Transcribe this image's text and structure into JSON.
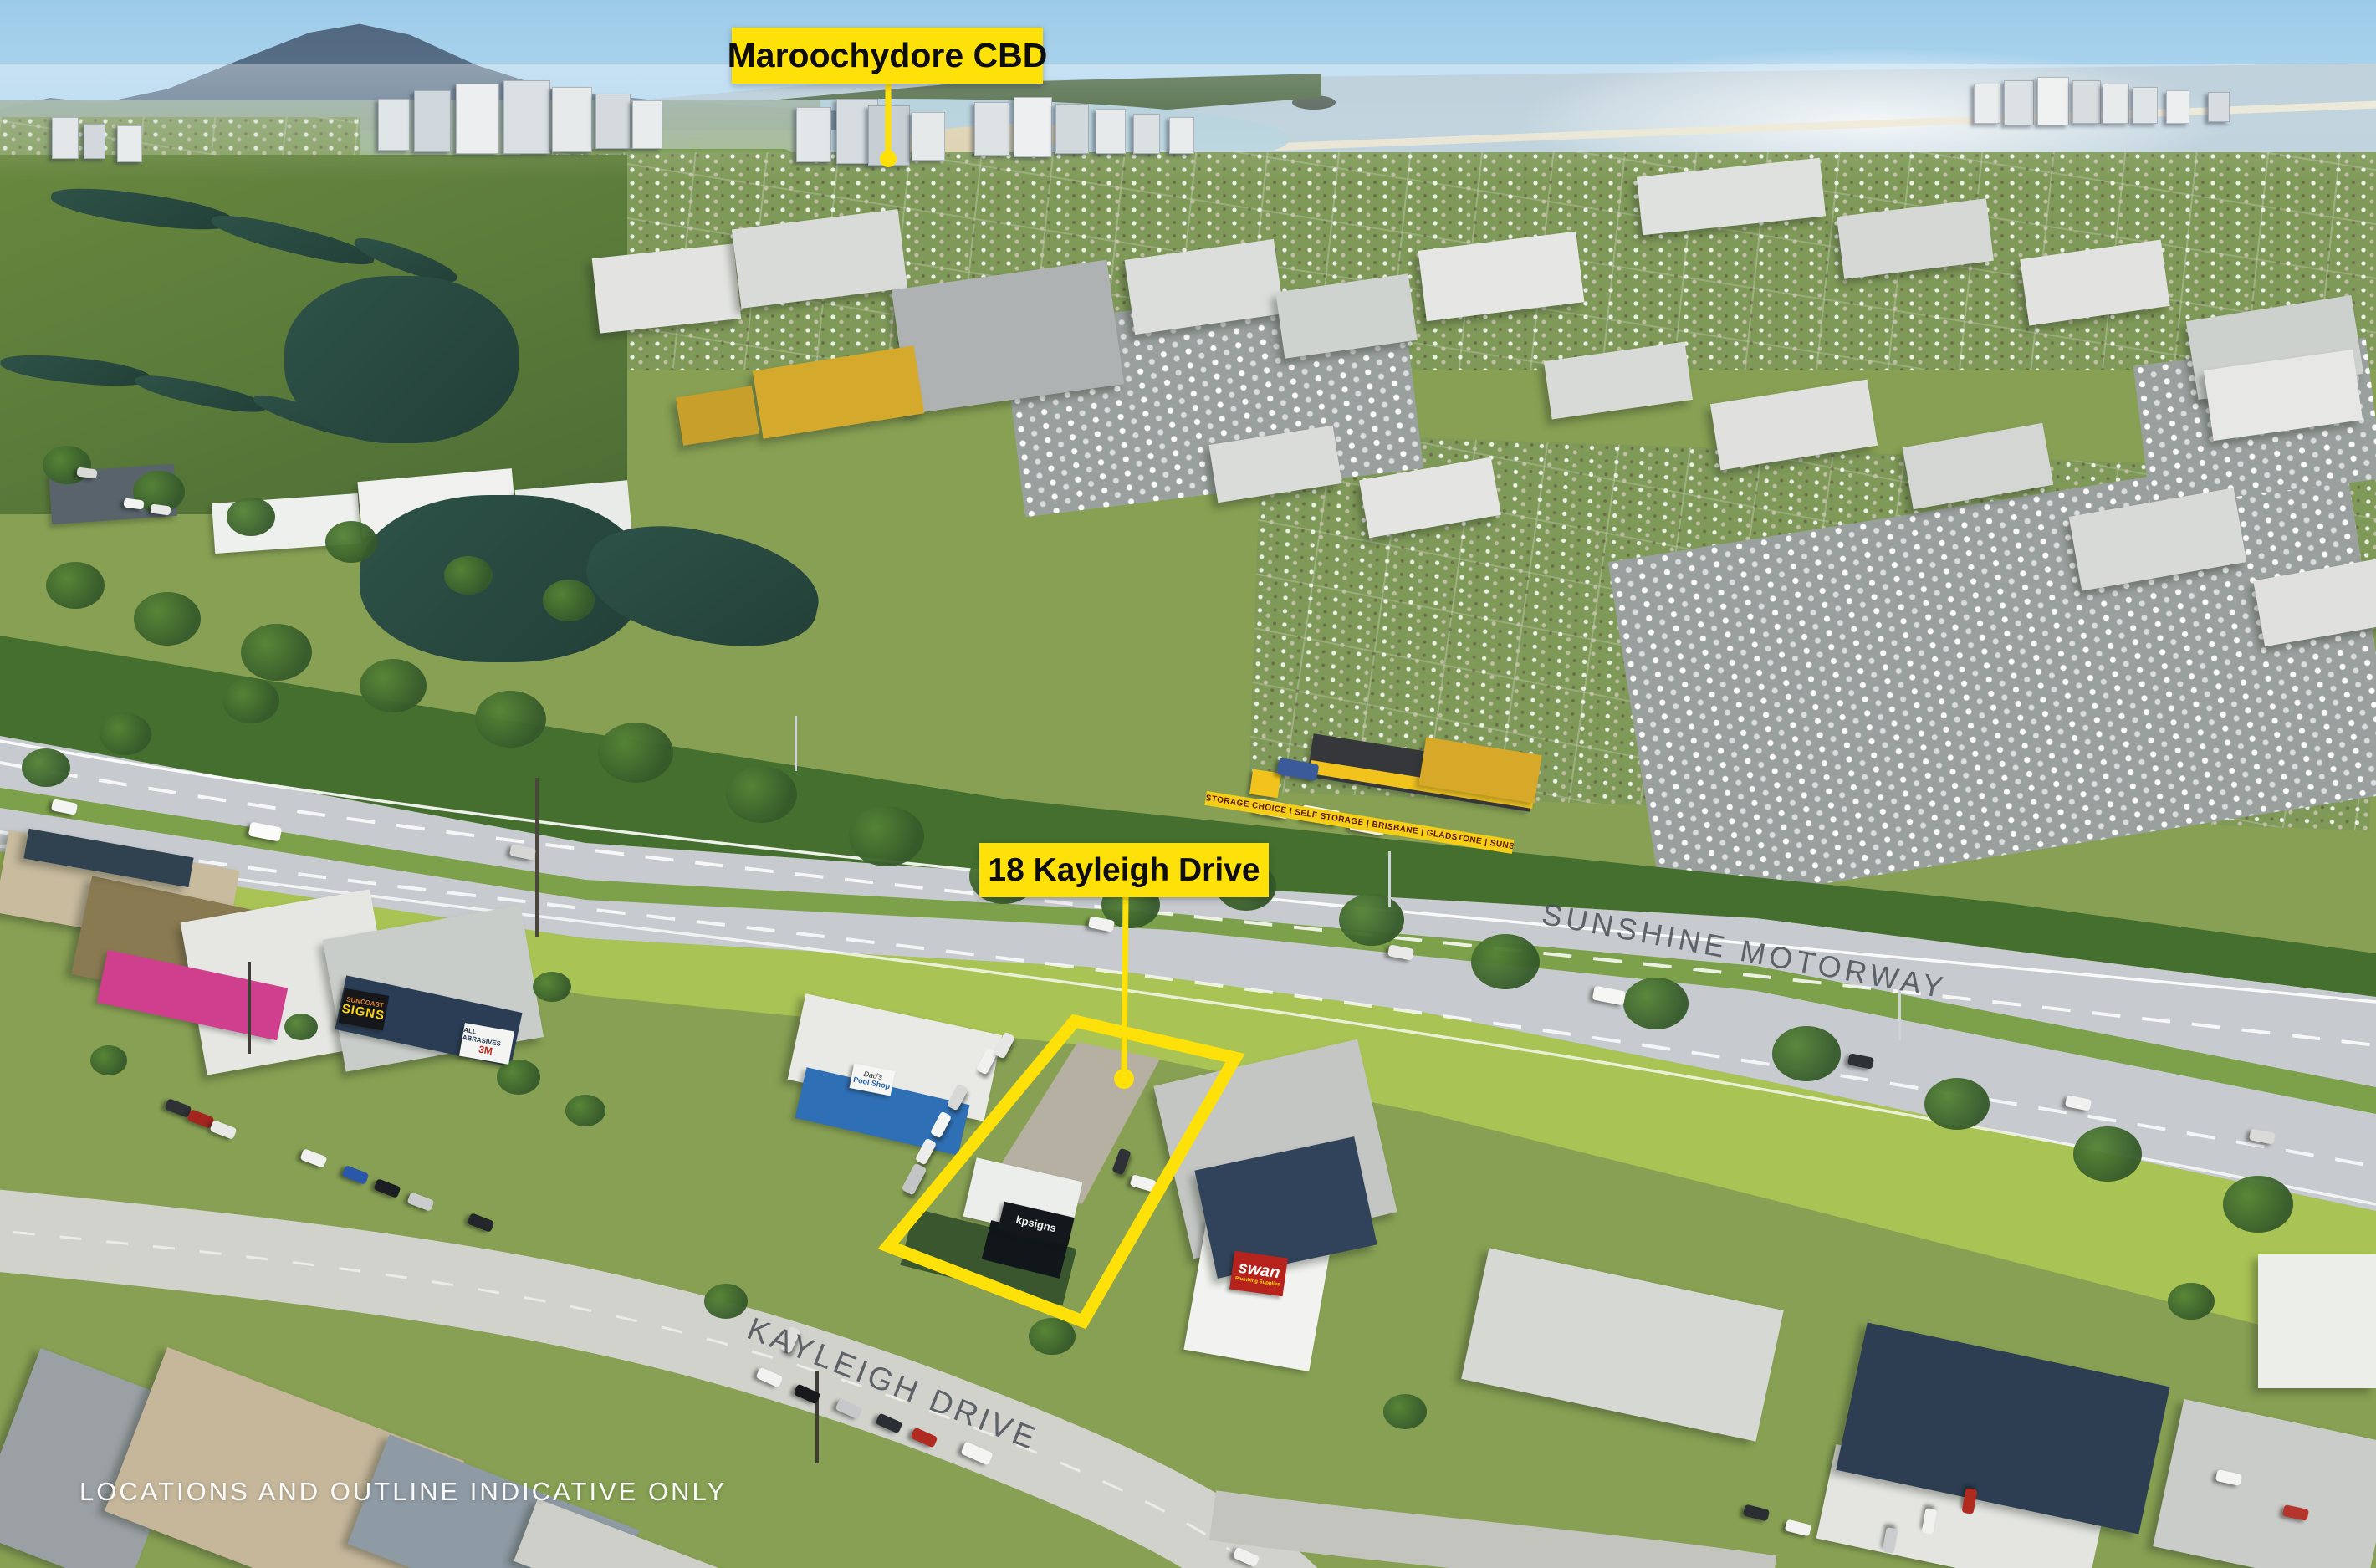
{
  "annotations": {
    "cbd_label": "Maroochydore CBD",
    "property_label": "18 Kayleigh Drive",
    "disclaimer": "LOCATIONS AND OUTLINE INDICATIVE ONLY"
  },
  "road_names": {
    "motorway": "SUNSHINE MOTORWAY",
    "street": "KAYLEIGH DRIVE"
  },
  "signage": {
    "storage_banner": "STORAGE CHOICE | SELF STORAGE | BRISBANE | GLADSTONE | SUNSHINE COAST",
    "suncoast_line1": "SUNCOAST",
    "suncoast_line2": "SIGNS",
    "all_abrasives": "ALL ABRASIVES",
    "three_m": "3M",
    "swan": "swan",
    "swan_tagline": "Plumbing Supplies",
    "kpsigns": "kpsigns",
    "pool_shop_line1": "Dad's",
    "pool_shop_line2": "Pool Shop"
  },
  "colors": {
    "annotation_yellow": "#FFE10A",
    "annotation_text": "#0d0d0d",
    "road_text_gray": "#4a5157",
    "disclaimer_white": "#ffffff"
  }
}
